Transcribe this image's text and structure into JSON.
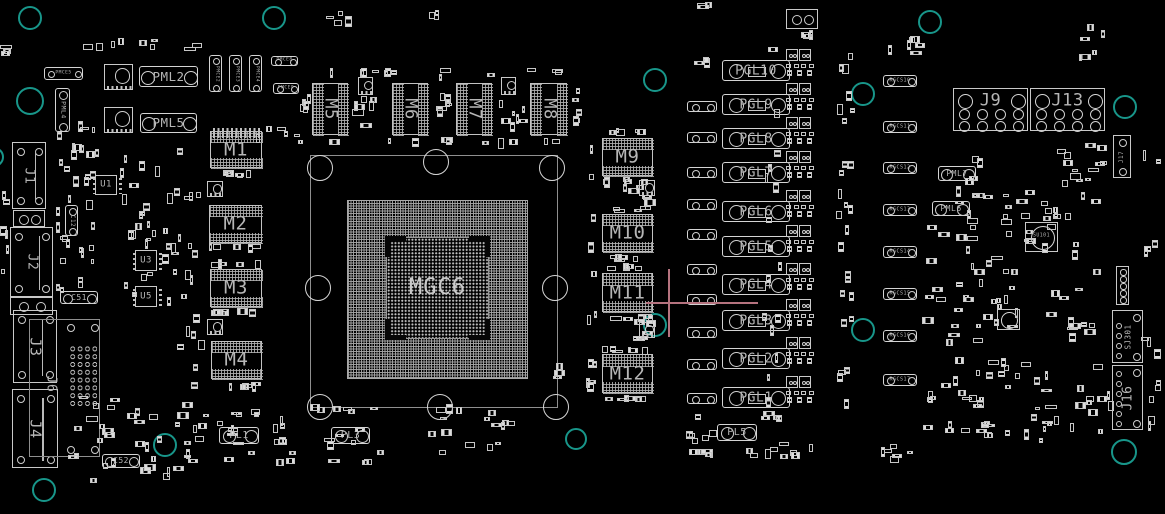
{
  "board": {
    "width": 1165,
    "height": 514,
    "bg": "#000000",
    "line": "#c9c9c9",
    "label_color": "#b6b6b6",
    "teal": "#18968a",
    "pink": "#b5737f"
  },
  "gpu": {
    "label": "MGC6",
    "pkg": [
      310,
      155,
      248,
      253
    ],
    "bga": [
      347,
      200,
      181,
      179
    ],
    "die": [
      386,
      237,
      103,
      102
    ]
  },
  "memories": [
    {
      "label": "M1",
      "x": 210,
      "y": 131,
      "w": 52,
      "h": 37,
      "vert": false
    },
    {
      "label": "M2",
      "x": 209,
      "y": 205,
      "w": 53,
      "h": 38,
      "vert": false
    },
    {
      "label": "M3",
      "x": 210,
      "y": 269,
      "w": 52,
      "h": 38,
      "vert": false
    },
    {
      "label": "M4",
      "x": 211,
      "y": 341,
      "w": 51,
      "h": 38,
      "vert": false
    },
    {
      "label": "M5",
      "x": 312,
      "y": 83,
      "w": 36,
      "h": 52,
      "vert": true
    },
    {
      "label": "M6",
      "x": 392,
      "y": 83,
      "w": 36,
      "h": 52,
      "vert": true
    },
    {
      "label": "M7",
      "x": 456,
      "y": 83,
      "w": 36,
      "h": 52,
      "vert": true
    },
    {
      "label": "M8",
      "x": 530,
      "y": 83,
      "w": 37,
      "h": 52,
      "vert": true
    },
    {
      "label": "M9",
      "x": 602,
      "y": 138,
      "w": 51,
      "h": 38,
      "vert": false
    },
    {
      "label": "M10",
      "x": 602,
      "y": 214,
      "w": 51,
      "h": 38,
      "vert": false
    },
    {
      "label": "M11",
      "x": 602,
      "y": 273,
      "w": 51,
      "h": 39,
      "vert": false
    },
    {
      "label": "M12",
      "x": 602,
      "y": 354,
      "w": 51,
      "h": 39,
      "vert": false
    }
  ],
  "inductors": [
    {
      "label": "PGL10",
      "x": 722,
      "y": 60,
      "w": 68,
      "h": 21
    },
    {
      "label": "PGL9",
      "x": 722,
      "y": 94,
      "w": 68,
      "h": 21
    },
    {
      "label": "PGL8",
      "x": 722,
      "y": 128,
      "w": 68,
      "h": 21
    },
    {
      "label": "PGL7",
      "x": 722,
      "y": 162,
      "w": 68,
      "h": 21
    },
    {
      "label": "PGL6",
      "x": 722,
      "y": 201,
      "w": 68,
      "h": 21
    },
    {
      "label": "PGL5",
      "x": 722,
      "y": 236,
      "w": 68,
      "h": 21
    },
    {
      "label": "PGL4",
      "x": 722,
      "y": 274,
      "w": 68,
      "h": 21
    },
    {
      "label": "PGL3",
      "x": 722,
      "y": 310,
      "w": 68,
      "h": 21
    },
    {
      "label": "PGL2",
      "x": 722,
      "y": 348,
      "w": 68,
      "h": 21
    },
    {
      "label": "PGL1",
      "x": 722,
      "y": 387,
      "w": 68,
      "h": 21
    }
  ],
  "pl_inductors": [
    {
      "label": "PL1",
      "x": 219,
      "y": 427,
      "w": 40,
      "h": 17
    },
    {
      "label": "PL3",
      "x": 331,
      "y": 427,
      "w": 39,
      "h": 17
    },
    {
      "label": "PL5",
      "x": 717,
      "y": 424,
      "w": 40,
      "h": 17
    }
  ],
  "pml": [
    {
      "label": "PML2",
      "x": 139,
      "y": 66,
      "w": 59,
      "h": 21,
      "vert": false,
      "fs": 12.5
    },
    {
      "label": "PML5",
      "x": 140,
      "y": 113,
      "w": 57,
      "h": 20,
      "vert": false,
      "fs": 12.5
    },
    {
      "label": "PML4",
      "x": 55,
      "y": 88,
      "w": 15,
      "h": 44,
      "vert": true,
      "fs": 6.5
    },
    {
      "label": "PML7",
      "x": 938,
      "y": 166,
      "w": 38,
      "h": 15,
      "vert": false,
      "fs": 8
    },
    {
      "label": "PML6",
      "x": 932,
      "y": 201,
      "w": 38,
      "h": 15,
      "vert": false,
      "fs": 8
    }
  ],
  "pmce": [
    {
      "label": "PMCE5",
      "x": 44,
      "y": 67,
      "w": 39,
      "h": 13,
      "vert": false
    },
    {
      "label": "PMCE2",
      "x": 209,
      "y": 55,
      "w": 13,
      "h": 37,
      "vert": true
    },
    {
      "label": "PMCE3",
      "x": 229,
      "y": 55,
      "w": 13,
      "h": 37,
      "vert": true
    },
    {
      "label": "PMCE4",
      "x": 249,
      "y": 55,
      "w": 13,
      "h": 37,
      "vert": true
    },
    {
      "label": "PMCE8",
      "x": 271,
      "y": 56,
      "w": 27,
      "h": 10,
      "vert": false
    },
    {
      "label": "PMCE9",
      "x": 273,
      "y": 83,
      "w": 26,
      "h": 11,
      "vert": false
    }
  ],
  "rgcs": [
    {
      "label": "RGCS10",
      "x": 883,
      "y": 75,
      "w": 34,
      "h": 12
    },
    {
      "label": "RGCS11",
      "x": 883,
      "y": 121,
      "w": 34,
      "h": 12
    },
    {
      "label": "RGCS12",
      "x": 883,
      "y": 162,
      "w": 34,
      "h": 12
    },
    {
      "label": "RGCS13",
      "x": 883,
      "y": 204,
      "w": 34,
      "h": 12
    },
    {
      "label": "RGCS14",
      "x": 883,
      "y": 246,
      "w": 34,
      "h": 12
    },
    {
      "label": "RGCS15",
      "x": 883,
      "y": 288,
      "w": 34,
      "h": 12
    },
    {
      "label": "RGCS16",
      "x": 883,
      "y": 330,
      "w": 34,
      "h": 12
    },
    {
      "label": "RGCS17",
      "x": 883,
      "y": 374,
      "w": 34,
      "h": 12
    }
  ],
  "caps": [
    {
      "label": "C12",
      "x": 65,
      "y": 205,
      "w": 13,
      "h": 31,
      "vert": true,
      "fs": 6
    },
    {
      "label": "C51",
      "x": 60,
      "y": 291,
      "w": 38,
      "h": 13,
      "vert": false,
      "fs": 8
    },
    {
      "label": "C52",
      "x": 102,
      "y": 454,
      "w": 38,
      "h": 14,
      "vert": false,
      "fs": 8
    }
  ],
  "ics": [
    {
      "label": "U1",
      "x": 95,
      "y": 175,
      "w": 22,
      "h": 20
    },
    {
      "label": "U3",
      "x": 135,
      "y": 250,
      "w": 22,
      "h": 21
    },
    {
      "label": "U5",
      "x": 135,
      "y": 286,
      "w": 22,
      "h": 21
    }
  ],
  "su": [
    {
      "label": "SU101",
      "x": 1025,
      "y": 222,
      "w": 33,
      "h": 30
    },
    {
      "label": "",
      "x": 997,
      "y": 309,
      "w": 23,
      "h": 21
    }
  ],
  "connectors": {
    "left": [
      {
        "label": "J1",
        "x": 12,
        "y": 142,
        "w": 34,
        "h": 67,
        "fs": 13
      },
      {
        "label": "J2",
        "x": 10,
        "y": 227,
        "w": 43,
        "h": 70,
        "fs": 13
      },
      {
        "label": "J3",
        "x": 13,
        "y": 310,
        "w": 44,
        "h": 73,
        "fs": 15
      },
      {
        "label": "J4",
        "x": 12,
        "y": 389,
        "w": 46,
        "h": 79,
        "fs": 15
      }
    ],
    "bracket": {
      "label": "J6",
      "x": 29,
      "y": 319,
      "w": 71,
      "h": 138,
      "fs": 13
    },
    "power": [
      {
        "label": "J9",
        "x": 953,
        "y": 88,
        "w": 75,
        "h": 43,
        "fs": 17
      },
      {
        "label": "J13",
        "x": 1030,
        "y": 88,
        "w": 75,
        "h": 43,
        "fs": 17
      }
    ],
    "right": [
      {
        "label": "J17",
        "x": 1113,
        "y": 135,
        "w": 18,
        "h": 43,
        "fs": 6
      },
      {
        "label": "SJ301",
        "x": 1112,
        "y": 310,
        "w": 31,
        "h": 53,
        "fs": 7.5
      },
      {
        "label": "J16",
        "x": 1112,
        "y": 365,
        "w": 31,
        "h": 65,
        "fs": 13
      }
    ],
    "small_boxes": [
      [
        13,
        210,
        32,
        17
      ],
      [
        10,
        297,
        43,
        18
      ],
      [
        786,
        9,
        32,
        20
      ]
    ],
    "header5": [
      1116,
      266,
      13,
      39
    ]
  },
  "holes_teal": [
    [
      30,
      18,
      12
    ],
    [
      274,
      18,
      12
    ],
    [
      930,
      22,
      12
    ],
    [
      30,
      101,
      14
    ],
    [
      -6,
      157,
      10
    ],
    [
      655,
      80,
      12
    ],
    [
      863,
      94,
      12
    ],
    [
      1125,
      107,
      12
    ],
    [
      655,
      325,
      12
    ],
    [
      863,
      330,
      12
    ],
    [
      165,
      445,
      12
    ],
    [
      576,
      439,
      11
    ],
    [
      1124,
      452,
      13
    ],
    [
      44,
      490,
      12
    ]
  ],
  "holes_white": [
    [
      320,
      168
    ],
    [
      436,
      162
    ],
    [
      552,
      168
    ],
    [
      318,
      288
    ],
    [
      555,
      288
    ],
    [
      320,
      407
    ],
    [
      440,
      407
    ],
    [
      556,
      407
    ]
  ],
  "crosshair": {
    "x": 669,
    "y": 303,
    "h_from": 646,
    "h_to": 758,
    "v_from": 269,
    "v_to": 337
  },
  "dogbones": [
    [
      687,
      101
    ],
    [
      687,
      132
    ],
    [
      687,
      167
    ],
    [
      687,
      199
    ],
    [
      687,
      229
    ],
    [
      687,
      264
    ],
    [
      687,
      294
    ],
    [
      687,
      327
    ],
    [
      687,
      359
    ],
    [
      687,
      393
    ]
  ],
  "chokes": [
    [
      104,
      64,
      29,
      26
    ],
    [
      104,
      107,
      29,
      26
    ],
    [
      207,
      181,
      16,
      16
    ],
    [
      207,
      319,
      16,
      16
    ],
    [
      358,
      77,
      15,
      18
    ],
    [
      501,
      77,
      15,
      18
    ],
    [
      639,
      180,
      16,
      16
    ],
    [
      639,
      322,
      16,
      16
    ]
  ],
  "mosfet_phases": [
    71,
    105,
    139,
    173,
    212,
    247,
    285,
    321,
    359,
    398
  ],
  "pad_strips": [
    [
      213,
      128,
      48,
      10
    ]
  ],
  "clusters": [
    [
      0,
      38,
      12,
      18,
      3
    ],
    [
      0,
      162,
      10,
      130,
      6
    ],
    [
      52,
      118,
      50,
      45,
      8
    ],
    [
      55,
      142,
      46,
      165,
      26
    ],
    [
      118,
      140,
      42,
      160,
      20
    ],
    [
      160,
      142,
      46,
      248,
      26
    ],
    [
      83,
      38,
      135,
      13,
      9
    ],
    [
      255,
      124,
      58,
      20,
      6
    ],
    [
      325,
      5,
      30,
      22,
      4
    ],
    [
      426,
      8,
      18,
      16,
      3
    ],
    [
      695,
      0,
      20,
      10,
      3
    ],
    [
      312,
      68,
      262,
      9,
      12
    ],
    [
      312,
      137,
      262,
      9,
      10
    ],
    [
      299,
      74,
      13,
      52,
      5
    ],
    [
      430,
      72,
      22,
      55,
      7
    ],
    [
      352,
      96,
      36,
      38,
      7
    ],
    [
      496,
      96,
      34,
      38,
      7
    ],
    [
      572,
      74,
      12,
      55,
      5
    ],
    [
      208,
      170,
      56,
      9,
      6
    ],
    [
      208,
      243,
      56,
      9,
      5
    ],
    [
      208,
      259,
      56,
      9,
      5
    ],
    [
      208,
      308,
      56,
      9,
      6
    ],
    [
      208,
      382,
      56,
      9,
      6
    ],
    [
      586,
      134,
      12,
      258,
      12
    ],
    [
      600,
      128,
      54,
      8,
      5
    ],
    [
      600,
      177,
      54,
      8,
      5
    ],
    [
      622,
      182,
      36,
      24,
      6
    ],
    [
      600,
      206,
      54,
      8,
      5
    ],
    [
      600,
      254,
      54,
      8,
      5
    ],
    [
      598,
      263,
      56,
      8,
      5
    ],
    [
      600,
      314,
      54,
      8,
      5
    ],
    [
      630,
      318,
      34,
      24,
      6
    ],
    [
      597,
      346,
      58,
      8,
      6
    ],
    [
      600,
      395,
      54,
      8,
      6
    ],
    [
      60,
      395,
      140,
      88,
      34
    ],
    [
      180,
      404,
      208,
      64,
      40
    ],
    [
      395,
      396,
      138,
      60,
      16
    ],
    [
      552,
      358,
      13,
      22,
      3
    ],
    [
      694,
      55,
      20,
      14,
      3
    ],
    [
      795,
      30,
      22,
      10,
      3
    ],
    [
      762,
      46,
      20,
      368,
      16
    ],
    [
      836,
      52,
      20,
      368,
      26
    ],
    [
      686,
      410,
      34,
      55,
      11
    ],
    [
      740,
      442,
      76,
      18,
      9
    ],
    [
      760,
      407,
      26,
      22,
      4
    ],
    [
      865,
      440,
      50,
      25,
      6
    ],
    [
      885,
      34,
      55,
      24,
      7
    ],
    [
      1078,
      24,
      30,
      40,
      6
    ],
    [
      955,
      154,
      30,
      46,
      6
    ],
    [
      1040,
      137,
      70,
      52,
      13
    ],
    [
      920,
      190,
      192,
      158,
      78
    ],
    [
      920,
      352,
      196,
      96,
      56
    ],
    [
      1140,
      150,
      22,
      282,
      13
    ]
  ]
}
